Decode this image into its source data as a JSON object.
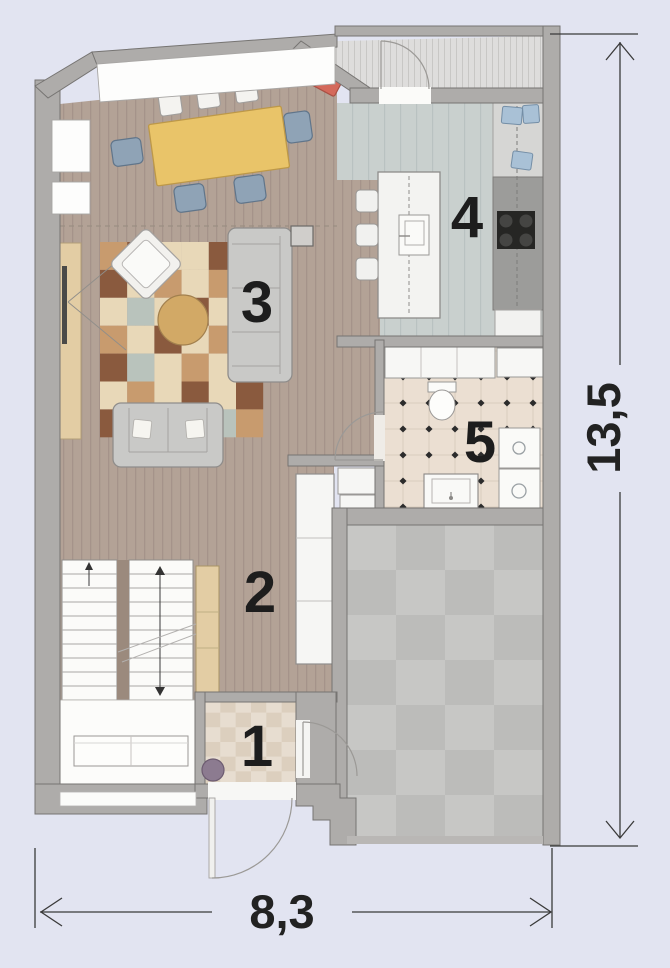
{
  "plan": {
    "room_labels": [
      {
        "id": "entry",
        "label": "1"
      },
      {
        "id": "hallway",
        "label": "2"
      },
      {
        "id": "living_room",
        "label": "3"
      },
      {
        "id": "kitchen",
        "label": "4"
      },
      {
        "id": "bathroom",
        "label": "5"
      }
    ],
    "dimensions": {
      "width_label": "8,3",
      "height_label": "13,5"
    }
  },
  "colors": {
    "background": "#e2e4f1",
    "wall": "#aeacaa",
    "wall_stroke": "#767472",
    "wood_floor": "#b3a296",
    "kitchen_floor": "#c9d0ce",
    "bathroom_floor": "#ebdfd2",
    "garage_tile_light": "#c7c7c5",
    "garage_tile_dark": "#bcbcba",
    "entry_tile_light": "#e7ddd0",
    "entry_tile_dark": "#dccfbe",
    "accent_red": "#d4695b",
    "chair_blue": "#8fa3b6",
    "table_yellow": "#e9c469",
    "coffee_table_tan": "#d2a966",
    "cabinet_beige": "#e3cda4",
    "plant_purple": "#8c7b90",
    "dimension_line": "#3a3a3a"
  },
  "rug": {
    "palette": [
      "#e8d8b8",
      "#c89b6e",
      "#8a5a3e",
      "#b9c3bc",
      "#e0c9a2"
    ],
    "pattern": [
      [
        1,
        2,
        0,
        0,
        2,
        0
      ],
      [
        2,
        0,
        1,
        0,
        1,
        1
      ],
      [
        0,
        3,
        0,
        2,
        0,
        2
      ],
      [
        1,
        0,
        2,
        0,
        1,
        0
      ],
      [
        2,
        3,
        0,
        1,
        0,
        1
      ],
      [
        0,
        1,
        0,
        2,
        0,
        2
      ],
      [
        2,
        0,
        1,
        0,
        3,
        1
      ]
    ]
  },
  "garage_checker": {
    "cols": 4,
    "rows": 7
  },
  "entry_checker": {
    "cols": 6,
    "rows": 6
  }
}
